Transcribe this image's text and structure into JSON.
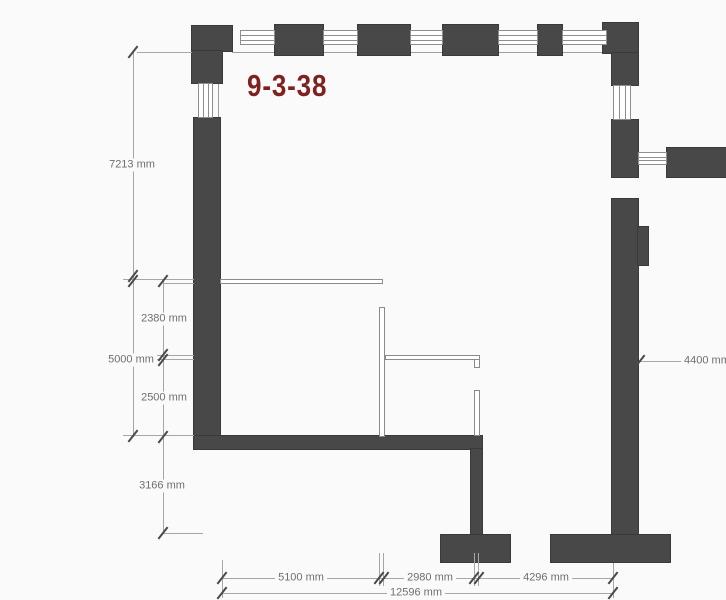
{
  "plan": {
    "unit_label": "9-3-38",
    "colors": {
      "wall": "#484848",
      "unit_label_red": "#7e2220",
      "dimension_gray": "#6f6f6f"
    },
    "dimensions": {
      "left_total_height": "7213 mm",
      "left_lower_height": "5000 mm",
      "inner_upper_height": "2380 mm",
      "inner_lower_height": "2500 mm",
      "below_offset": "3166 mm",
      "bottom_left_width": "5100 mm",
      "bottom_middle_width": "2980 mm",
      "bottom_right_width": "4296 mm",
      "bottom_total_width": "12596 mm",
      "right_wall_length": "4400 mm"
    }
  }
}
